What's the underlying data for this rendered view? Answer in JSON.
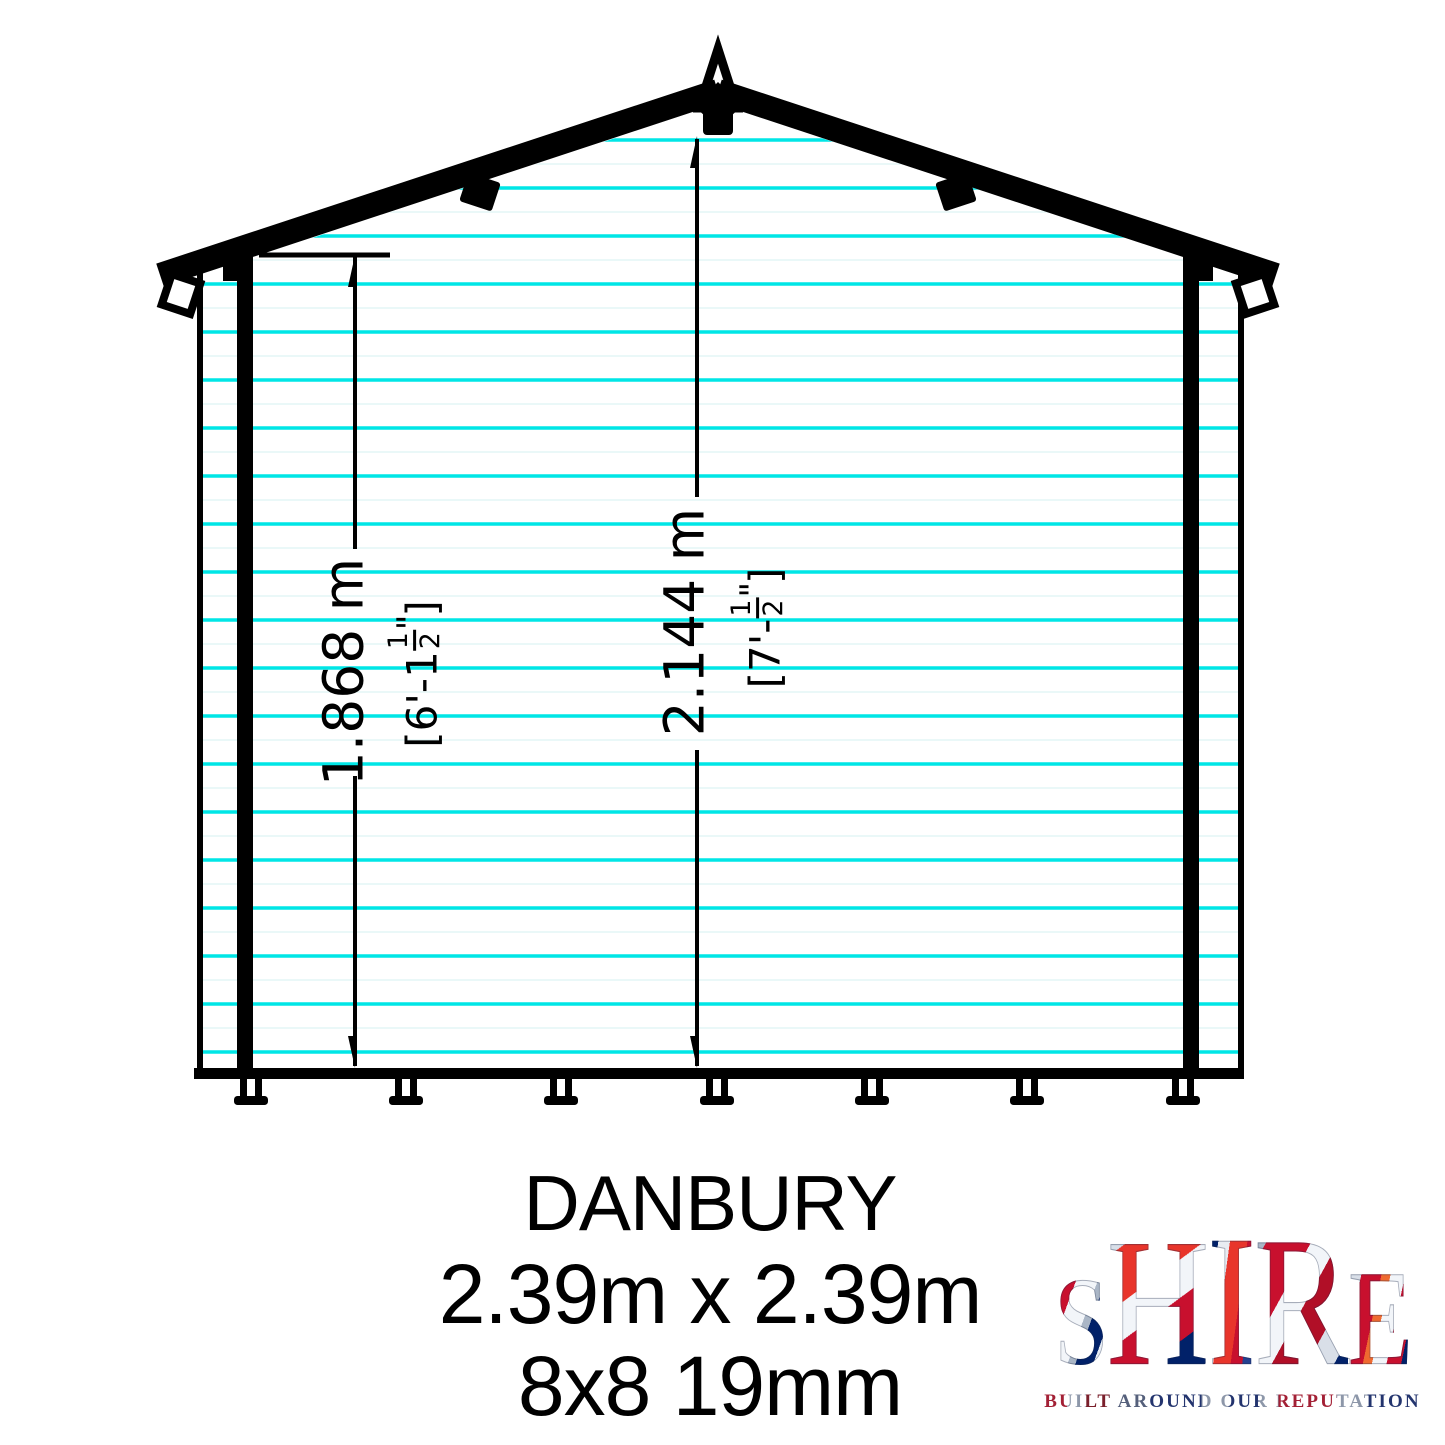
{
  "title": {
    "name": "DANBURY",
    "size": "2.39m x 2.39m",
    "spec": "8x8 19mm"
  },
  "dims": {
    "eaves": {
      "metric": "1.868 m",
      "imp_open": "[6'-1",
      "frac_num": "1",
      "frac_den": "2",
      "unit_mark": "\"",
      "close": "]"
    },
    "ridge": {
      "metric": "2.144 m",
      "imp_open": "[7'-",
      "frac_num": "1",
      "frac_den": "2",
      "unit_mark": "\"",
      "close": "]"
    }
  },
  "logo": {
    "letters": [
      "S",
      "H",
      "I",
      "R",
      "E"
    ],
    "tagline": "BUILT AROUND OUR REPUTATION",
    "flag_red": "#C8102E",
    "flag_blue": "#012169",
    "flag_silver": "#D9DFE8"
  },
  "drawing": {
    "cladding_line_color": "#00E6E6",
    "ink_color": "#000000"
  }
}
